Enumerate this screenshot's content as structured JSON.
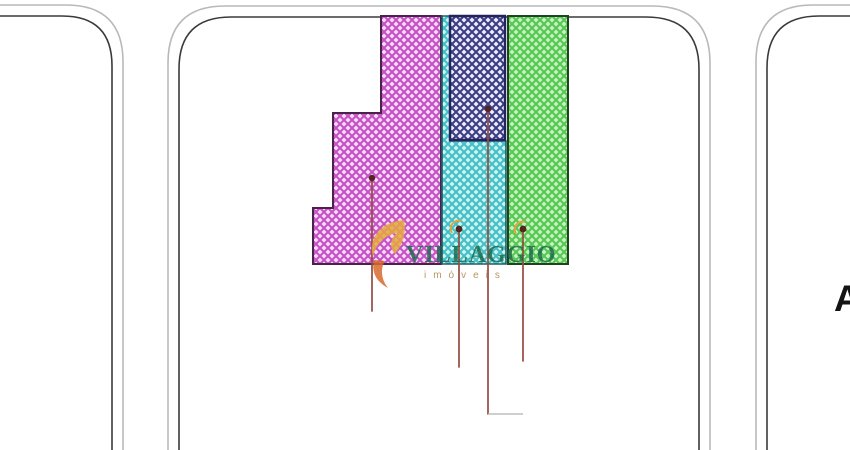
{
  "watermark": {
    "brand": "VILLAGGIO",
    "subtitle": "imóveis",
    "text_color": "#1d6b4e",
    "subtitle_color": "#a8854e",
    "swoosh_gold": "#e6a93e",
    "swoosh_orange": "#d86a30"
  },
  "street_label": "A",
  "streets": {
    "outer_line_color": "#b9b9b9",
    "inner_line_color": "#3a3a3a"
  },
  "zones": {
    "magenta": {
      "bg": "#f8dcf6",
      "line": "#c650c6",
      "border": "#4a2148"
    },
    "navy": {
      "bg": "#eceefa",
      "line": "#3d3d86",
      "border": "#23235e"
    },
    "cyan": {
      "bg": "#ccf4f2",
      "line": "#44bfc6",
      "border": "#1d5f66"
    },
    "green": {
      "bg": "#c9f1bd",
      "line": "#54c754",
      "border": "#1e431e"
    }
  },
  "pins": {
    "stem_color": "#964a40",
    "dot_color": "#56231d",
    "halo_color": "#dda545",
    "leader_tail_color": "#bdbdbd"
  }
}
